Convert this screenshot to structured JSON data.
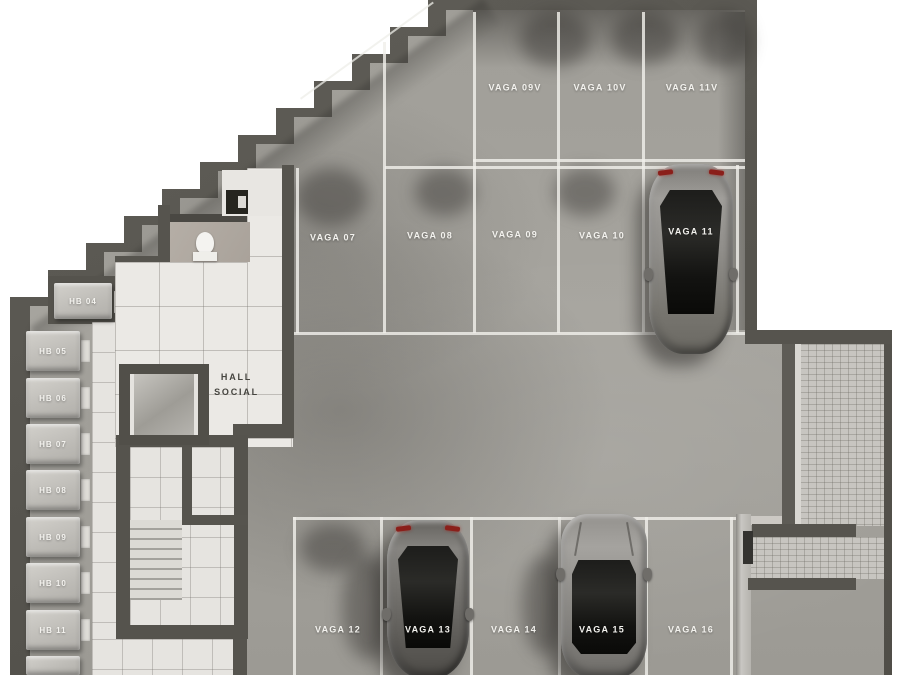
{
  "plan": {
    "type": "parking-garage-floor-plan",
    "hall": {
      "line1": "HALL",
      "line2": "SOCIAL"
    },
    "parking": {
      "top_row": [
        {
          "label": "VAGA 09V"
        },
        {
          "label": "VAGA 10V"
        },
        {
          "label": "VAGA 11V"
        }
      ],
      "middle_row": [
        {
          "label": "VAGA 07"
        },
        {
          "label": "VAGA 08"
        },
        {
          "label": "VAGA 09"
        },
        {
          "label": "VAGA 10"
        },
        {
          "label": "VAGA 11",
          "occupied": true
        }
      ],
      "bottom_row": [
        {
          "label": "VAGA 12"
        },
        {
          "label": "VAGA 13",
          "occupied": true
        },
        {
          "label": "VAGA 14"
        },
        {
          "label": "VAGA 15",
          "occupied": true
        },
        {
          "label": "VAGA 16"
        }
      ]
    },
    "storage_units": [
      {
        "label": "HB 04"
      },
      {
        "label": "HB 05"
      },
      {
        "label": "HB 06"
      },
      {
        "label": "HB 07"
      },
      {
        "label": "HB 08"
      },
      {
        "label": "HB 09"
      },
      {
        "label": "HB 10"
      },
      {
        "label": "HB 11"
      }
    ],
    "cars": [
      {
        "space": "VAGA 11",
        "style": "sedan",
        "color": "silver-gray",
        "orientation": "rear-at-top"
      },
      {
        "space": "VAGA 13",
        "style": "sedan",
        "color": "dark-gray",
        "orientation": "rear-at-top"
      },
      {
        "space": "VAGA 15",
        "style": "suv",
        "color": "gray",
        "orientation": "front-at-top"
      }
    ],
    "colors": {
      "outside": "#ffffff",
      "wall": "#56544e",
      "asphalt": "#a3a19b",
      "marking_line": "#f0efea",
      "tile_floor": "#ebe9e5",
      "paver": "#c7c5c0",
      "label_text": "#f3f2ee",
      "hall_text": "#45443f",
      "taillight": "#8a1f1a"
    }
  }
}
